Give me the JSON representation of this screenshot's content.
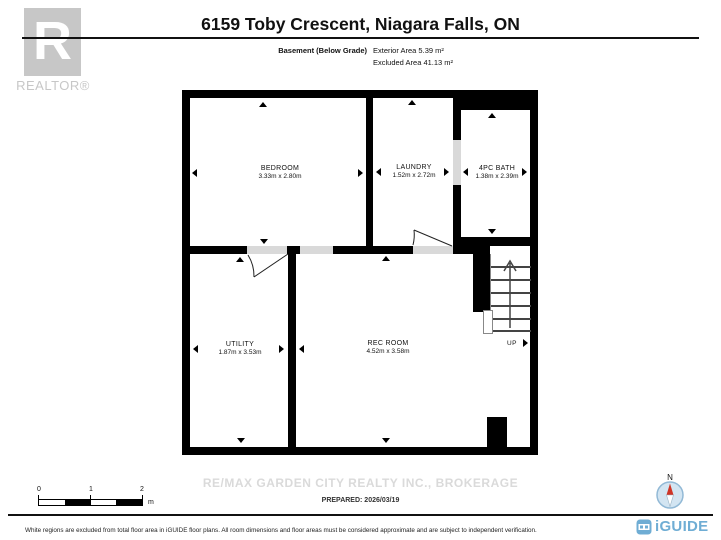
{
  "header": {
    "title": "6159 Toby Crescent, Niagara Falls, ON",
    "floor_label": "Basement (Below Grade)",
    "exterior_area": "Exterior Area 5.39 m²",
    "excluded_area": "Excluded Area 41.13 m²",
    "realtor_logo_letter": "R",
    "realtor_logo_text": "REALTOR®"
  },
  "rooms": [
    {
      "name": "BEDROOM",
      "dims": "3.33m x 2.80m"
    },
    {
      "name": "LAUNDRY",
      "dims": "1.52m x 2.72m"
    },
    {
      "name": "4PC BATH",
      "dims": "1.38m x 2.39m"
    },
    {
      "name": "UTILITY",
      "dims": "1.87m x 3.53m"
    },
    {
      "name": "REC ROOM",
      "dims": "4.52m x 3.58m"
    }
  ],
  "stairs_label": "UP",
  "footer": {
    "brokerage": "RE/MAX GARDEN CITY REALTY INC., BROKERAGE",
    "prepared": "PREPARED: 2026/03/19",
    "scale": {
      "ticks": [
        "0",
        "1",
        "2"
      ],
      "unit": "m"
    },
    "compass_label": "N",
    "brand": "iGUIDE",
    "disclaimer": "White regions are excluded from total floor area in iGUIDE floor plans. All room dimensions and floor areas must be considered approximate and are subject to independent verification."
  },
  "colors": {
    "wall": "#000000",
    "door_gray": "#d9d9d9",
    "logo_gray": "#c7c7c7",
    "watermark_gray": "#dadada",
    "iguide_blue": "#6fadd4",
    "compass_fill": "#d3e5f2",
    "compass_red": "#cf3526"
  }
}
